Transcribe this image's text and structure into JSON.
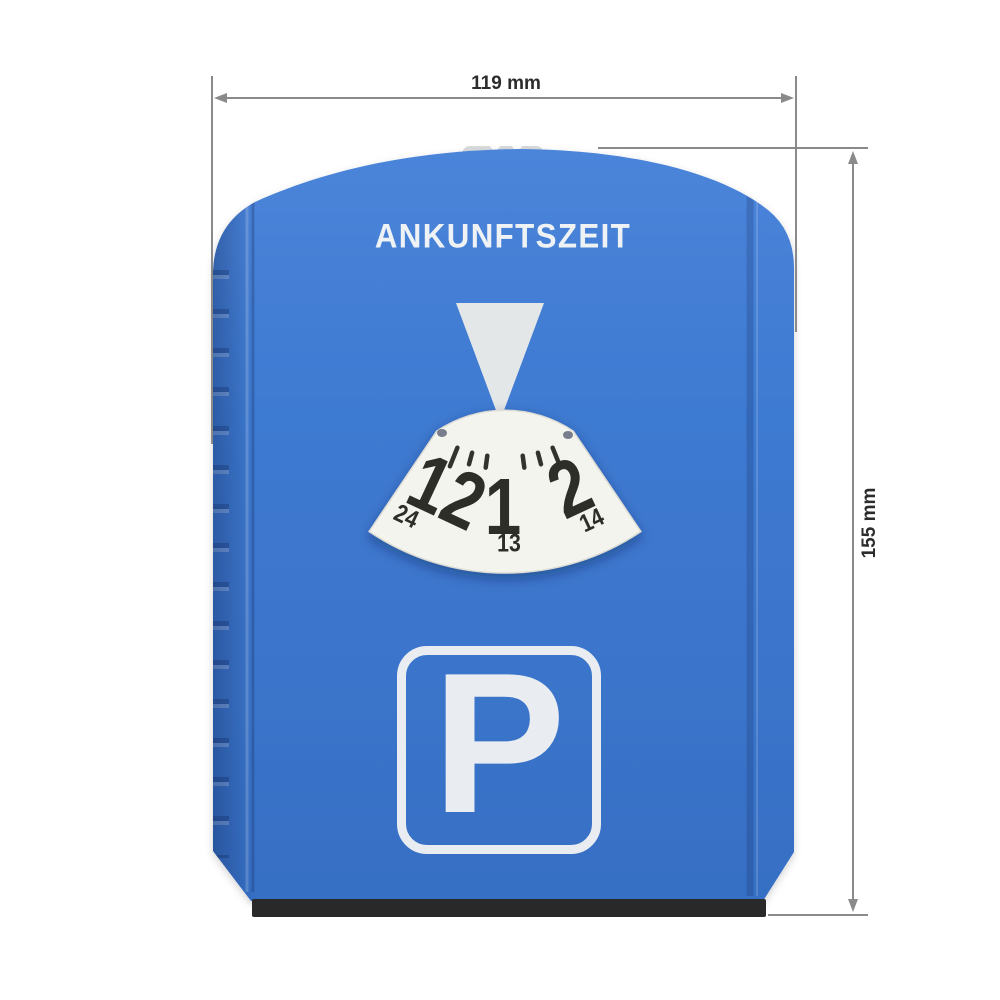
{
  "disc": {
    "heading": "ANKUNFTSZEIT",
    "parking_letter": "P",
    "dial": {
      "hours": [
        {
          "value": "12",
          "sub": "24"
        },
        {
          "value": "1",
          "sub": "13"
        },
        {
          "value": "2",
          "sub": "14"
        }
      ]
    }
  },
  "dimensions": {
    "width": "119 mm",
    "height": "155 mm"
  },
  "colors": {
    "body_blue": "#3b76cd",
    "body_blue_light": "#4b85da",
    "body_blue_dark": "#366fc4",
    "dial_white": "#f4f4ee",
    "sign_white": "#e9edf2",
    "pointer_gray": "#e3e7e7",
    "knob_gray": "#d7dbdb",
    "digit_dark": "#2e2e28",
    "scraper_black": "#292929",
    "dimension_line": "#8a8a8a",
    "dimension_text": "#2c2c2c"
  }
}
